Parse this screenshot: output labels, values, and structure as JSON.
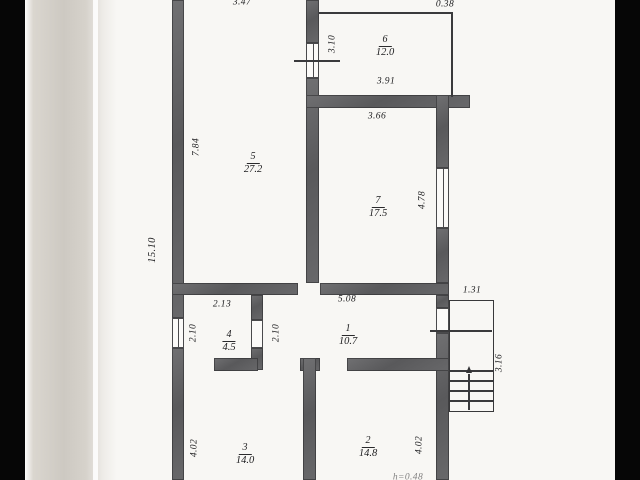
{
  "colors": {
    "backdrop": "#070707",
    "paper": "#f8f7f4",
    "page_edge": "#cdc9c2",
    "wall": "#5c5c5e",
    "thin_line": "#3a3a3c",
    "text": "#1d1d1f"
  },
  "rooms": {
    "r1": {
      "number": "1",
      "area": "10.7"
    },
    "r2": {
      "number": "2",
      "area": "14.8"
    },
    "r3": {
      "number": "3",
      "area": "14.0"
    },
    "r4": {
      "number": "4",
      "area": "4.5"
    },
    "r5": {
      "number": "5",
      "area": "27.2"
    },
    "r6": {
      "number": "6",
      "area": "12.0"
    },
    "r7": {
      "number": "7",
      "area": "17.5"
    }
  },
  "dims": {
    "t347": "3.47",
    "t038": "0.38",
    "v310": "3.10",
    "h391": "3.91",
    "h366": "3.66",
    "v784": "7.84",
    "v478": "4.78",
    "v1510": "15.10",
    "h213": "2.13",
    "h508": "5.08",
    "h131": "1.31",
    "v210a": "2.10",
    "v210b": "2.10",
    "v316": "3.16",
    "v402a": "4.02",
    "v402b": "4.02",
    "partial_bottom": "h=0.48"
  }
}
